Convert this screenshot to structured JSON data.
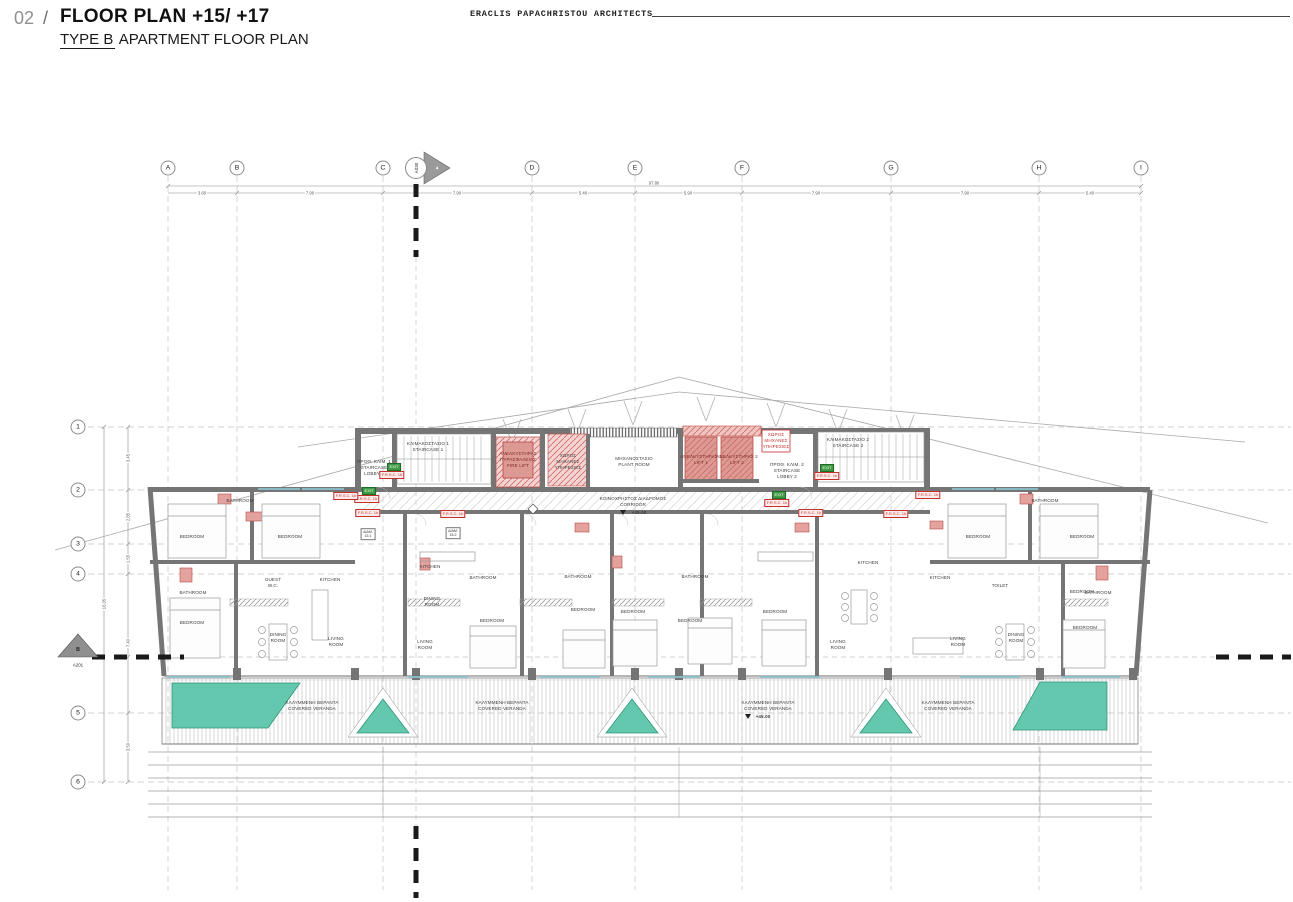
{
  "header": {
    "index": "02",
    "sep": "/",
    "title": "FLOOR PLAN +15/ +17",
    "subtitle_em": "TYPE B",
    "subtitle_rest": " APARTMENT FLOOR PLAN",
    "firm": "ERACLIS PAPACHRISTOU ARCHITECTS"
  },
  "grid": {
    "columns": [
      "A",
      "B",
      "C",
      "D",
      "E",
      "F",
      "G",
      "H",
      "I"
    ],
    "rows": [
      "1",
      "2",
      "3",
      "4",
      "5",
      "6"
    ],
    "top_dims": [
      "3.60",
      "7.90",
      "7.90",
      "5.40",
      "5.90",
      "7.90",
      "7.90",
      "5.40"
    ],
    "top_overall": "97.80",
    "left_dims": [
      "3.45",
      "2.85",
      "1.55",
      "7.40",
      "3.50"
    ],
    "left_overall": "16.05"
  },
  "markers": {
    "left_letter": "B",
    "left_sheet": "A201",
    "top_number": "4",
    "top_sheet": "A030"
  },
  "core": {
    "staircase1": "ΚΛΙΜΑΚΟΣΤΑΣΙΟ 1\nSTAIRCASE 1",
    "staircase2": "ΚΛΙΜΑΚΟΣΤΑΣΙΟ 2\nSTAIRCASE 2",
    "lobby1": "ΠΡΟΘ. ΚΛΙΜ. 1\nSTAIRCASE\nLOBBY 1",
    "lobby2": "ΠΡΟΘ. ΚΛΙΜ. 2\nSTAIRCASE\nLOBBY 2",
    "fire_lift": "ΑΝΕΛΚΥΣΤΗΡΑΣ\nΠΥΡΑΣΦΑΛΕΙΑΣ\nFIRE LIFT",
    "lift1": "ΑΝΕΛΚΥΣΤΗΡΑΣ 1\nLIFT 1",
    "lift2": "ΑΝΕΛΚΥΣΤΗΡΑΣ 2\nLIFT 2",
    "plant_room": "ΜΗΧΑΝΟΣΤΑΣΙΟ\nPLANT ROOM",
    "services": "ΧΩΡΟΣ\nΜΗΧΑΝΕΣ\nΥΠΗΡΕΣΙΕΣ",
    "corridor": "ΚΟΙΝΟΧΡΗΣΤΟΣ ΔΙΑΔΡΟΜΟΣ\nCORRIDOR",
    "corridor_level": "+45.00"
  },
  "rooms": {
    "bedroom": "BEDROOM",
    "bathroom": "BATHROOM",
    "guest_wc": "GUEST\nW.C.",
    "kitchen": "KITCHEN",
    "dining": "DINING\nROOM",
    "living": "LIVING\nROOM",
    "toilet": "TOILET"
  },
  "veranda": {
    "label": "ΚΑΛΥΜΜΕΝΗ ΒΕΡΑΝΤΑ\nCOVERED VERANDA",
    "level": "+45.00"
  },
  "tags": {
    "exit": "EXIT",
    "fire": "F.R.S.C. 1h",
    "unit1": "ΔΙΑΜ.\n15.1",
    "unit2": "ΔΙΑΜ.\n15.2"
  },
  "colors": {
    "wall_gray": "#757575",
    "lift_red": "#dd9a94",
    "pool_teal": "#63c8ad",
    "tag_green": "#3f9b45",
    "tag_red": "#c3312c"
  }
}
